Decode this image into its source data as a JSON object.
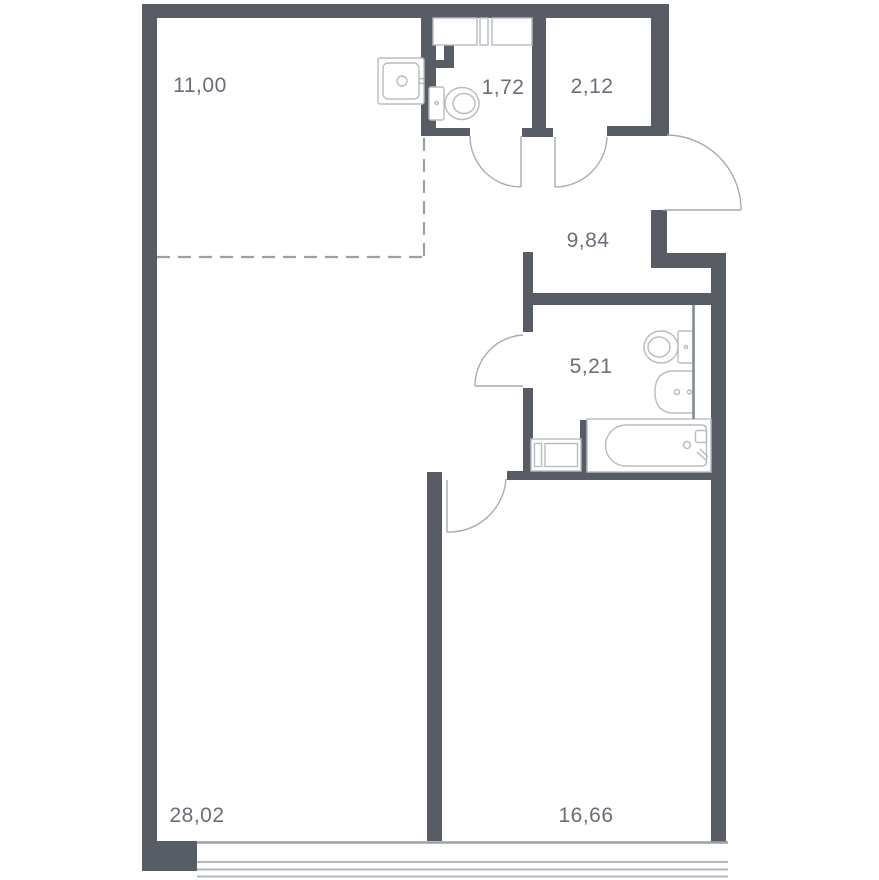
{
  "title": "apartment-floor-plan",
  "colors": {
    "background": "#ffffff",
    "wall": "#575c65",
    "door": "#a6acb4",
    "dashed": "#99a0a8",
    "fixture": "#b7bcc2",
    "plumb": "#848b94",
    "sill": "#9aa1a9",
    "glass": "#b3b8be",
    "label": "#696e77"
  },
  "rooms": [
    {
      "name": "kitchen-zone",
      "area": "11,00"
    },
    {
      "name": "wc",
      "area": "1,72"
    },
    {
      "name": "storage",
      "area": "2,12"
    },
    {
      "name": "hallway",
      "area": "9,84"
    },
    {
      "name": "bathroom",
      "area": "5,21"
    },
    {
      "name": "living-room",
      "area": "28,02"
    },
    {
      "name": "bedroom",
      "area": "16,66"
    }
  ],
  "fixtures": [
    "kitchen-sink",
    "wc-toilet",
    "wc-shelves",
    "bathroom-toilet",
    "bathroom-sink",
    "bathtub",
    "washing-machine"
  ],
  "doors": [
    "wc-door",
    "storage-door",
    "entrance-door",
    "bathroom-door",
    "bedroom-door"
  ],
  "window": "panoramic-window-band"
}
